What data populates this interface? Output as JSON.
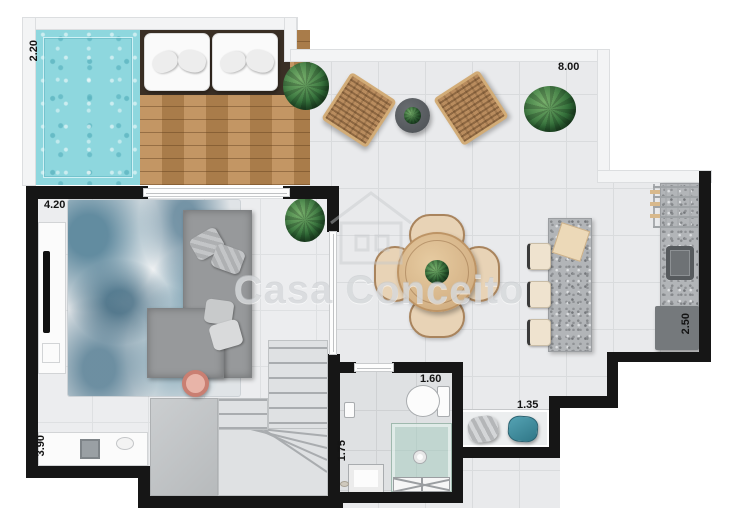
{
  "watermark": {
    "brand": "Casa Conceito"
  },
  "dimensions": {
    "pool_width": "2.20",
    "terrace_width": "8.00",
    "living_width": "4.20",
    "living_depth": "3.90",
    "kitchen_depth": "2.50",
    "bathroom_width": "1.60",
    "bathroom_depth": "1.75",
    "service_width": "1.35"
  },
  "palette": {
    "pool": "#8ed7de",
    "deck_wood": "#bc8a52",
    "wall": "#161616",
    "tile_floor": "#e9eaec",
    "rug_blue": "#386e88",
    "sofa_gray": "#97999b",
    "furniture_wood": "#d6b488",
    "granite": "#b2b5b8",
    "stove_gray": "#75797c",
    "pouf_teal": "#3f8ea0",
    "shower_glass": "#a8cdc1",
    "tray_pink": "#c97f72"
  }
}
